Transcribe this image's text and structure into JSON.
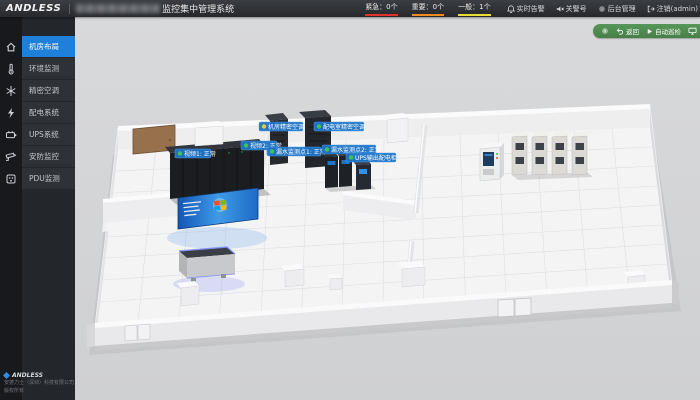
{
  "topbar": {
    "logo": "ANDLESS",
    "title": "监控集中管理系统",
    "alarm_counters": [
      {
        "text": "紧急：0个",
        "level": "紧急",
        "count": 0,
        "color": "#e0312b"
      },
      {
        "text": "重要：0个",
        "level": "重要",
        "count": 0,
        "color": "#ef8b1f"
      },
      {
        "text": "一般：1个",
        "level": "一般",
        "count": 1,
        "color": "#e9dc35"
      }
    ],
    "menu": [
      {
        "label": "实时告警",
        "icon": "bell-icon"
      },
      {
        "label": "关警号",
        "icon": "mute-icon"
      },
      {
        "label": "后台管理",
        "icon": "gear-icon"
      },
      {
        "label": "注销(admin)",
        "icon": "logout-icon"
      }
    ]
  },
  "sidebar": {
    "items": [
      {
        "label": "机房布局",
        "icon": "home-icon",
        "selected": true
      },
      {
        "label": "环境监测",
        "icon": "thermometer-icon",
        "selected": false
      },
      {
        "label": "精密空调",
        "icon": "aircon-icon",
        "selected": false
      },
      {
        "label": "配电系统",
        "icon": "power-icon",
        "selected": false
      },
      {
        "label": "UPS系统",
        "icon": "battery-icon",
        "selected": false
      },
      {
        "label": "安防监控",
        "icon": "camera-icon",
        "selected": false
      },
      {
        "label": "PDU监测",
        "icon": "pdu-icon",
        "selected": false
      }
    ],
    "footer": {
      "brand": "ANDLESS",
      "company": "安德力士（深圳）科技有限公司",
      "copyright": "版权所有"
    }
  },
  "toolbar": {
    "back_label": "返回",
    "patrol_label": "自动巡检",
    "icons": [
      "gear-icon",
      "undo-icon",
      "play-icon",
      "monitor-icon"
    ]
  },
  "room": {
    "labels": [
      {
        "text": "视频1: 正常",
        "status": "normal",
        "dot_color": "#41c24f"
      },
      {
        "text": "视频2: 正常",
        "status": "normal",
        "dot_color": "#41c24f"
      },
      {
        "text": "漏水监测点1: 正常",
        "status": "normal",
        "dot_color": "#41c24f"
      },
      {
        "text": "漏水监测点2: 正常",
        "status": "normal",
        "dot_color": "#41c24f"
      },
      {
        "text": "UPS输出配电柜",
        "status": "normal",
        "dot_color": "#41c24f"
      },
      {
        "text": "机房精密空调",
        "status": "warning",
        "dot_color": "#e8c937"
      },
      {
        "text": "配电室精密空调",
        "status": "normal",
        "dot_color": "#41c24f"
      }
    ]
  },
  "colors": {
    "topbar_bg": "#2c2f34",
    "sidebar_bg": "#23262b",
    "sidebar_icon_strip": "#17191d",
    "selected_blue": "#1e80d8",
    "content_bg": "#d3d4d6",
    "toolbar_green": "#4e8d4e",
    "label_pill_blue": "#1e74c8",
    "status_green": "#41c24f",
    "status_yellow": "#e8c937"
  }
}
